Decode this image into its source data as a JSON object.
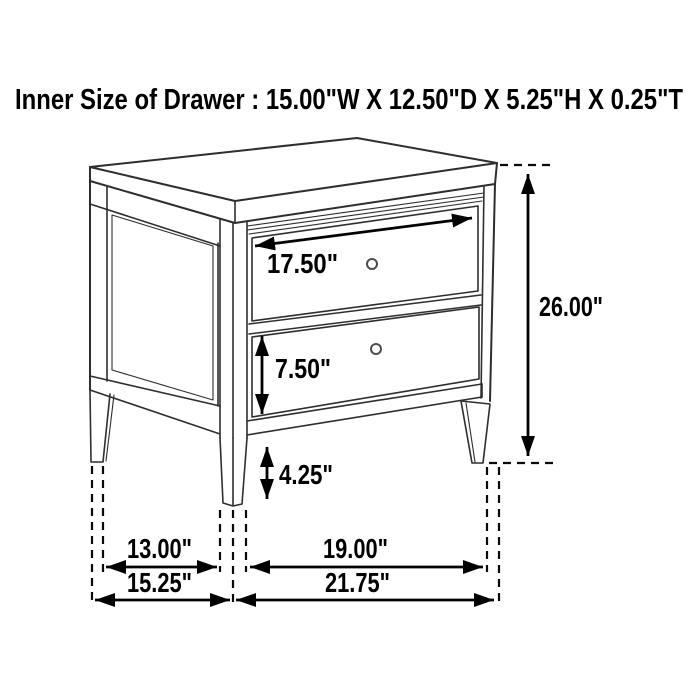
{
  "title": "Inner Size of Drawer : 15.00\"W X 12.50\"D X 5.25\"H X 0.25\"T",
  "diagram": {
    "type": "furniture-dimension-diagram",
    "subject": "two-drawer nightstand line drawing",
    "dimensions": {
      "drawer_width": "17.50\"",
      "overall_height": "26.00\"",
      "drawer_front_height": "7.50\"",
      "bottom_clearance": "4.25\"",
      "side_leg_spacing": "13.00\"",
      "front_leg_spacing": "19.00\"",
      "overall_depth": "15.25\"",
      "overall_width": "21.75\""
    },
    "colors": {
      "background": "#ffffff",
      "line_art": "#2e2e2e",
      "dimension_ink": "#000000",
      "knob_outline": "#4d4d4d"
    }
  }
}
